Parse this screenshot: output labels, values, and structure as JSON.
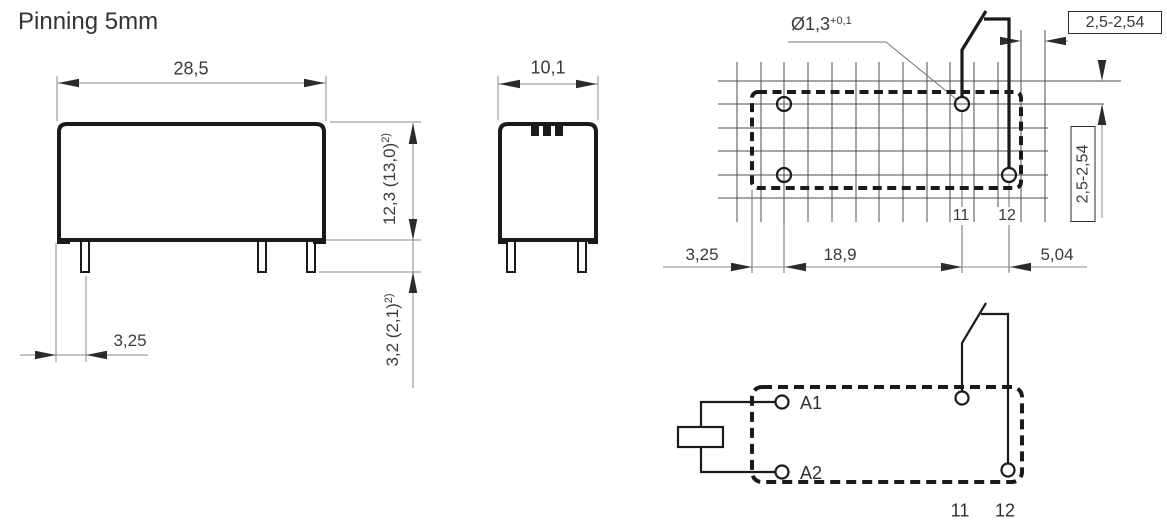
{
  "page": {
    "title": "Pinning 5mm"
  },
  "front_view": {
    "width": "28,5",
    "height": {
      "main": "12,3 (13,0)",
      "sup": "2)"
    },
    "pin_length": {
      "main": "3,2 (2,1)",
      "sup": "2)"
    },
    "pin_offset": "3,25"
  },
  "side_view": {
    "width": "10,1"
  },
  "drilling_plan": {
    "hole_diameter": {
      "main": "Ø1,3",
      "sup": "+0,1"
    },
    "pitch_horizontal": "2,5-2,54",
    "pitch_vertical": "2,5-2,54",
    "dim_edge_to_hole": "3,25",
    "dim_hole_span": "18,9",
    "dim_pin_spacing": "5,04",
    "pin11": "11",
    "pin12": "12"
  },
  "schematic": {
    "coil_a1": "A1",
    "coil_a2": "A2",
    "pin11": "11",
    "pin12": "12"
  },
  "colors": {
    "object_line": "#1a1a1a",
    "dim_line": "#8a8a8a",
    "grid_line": "#4d4d4d",
    "text": "#3a3a3a"
  }
}
